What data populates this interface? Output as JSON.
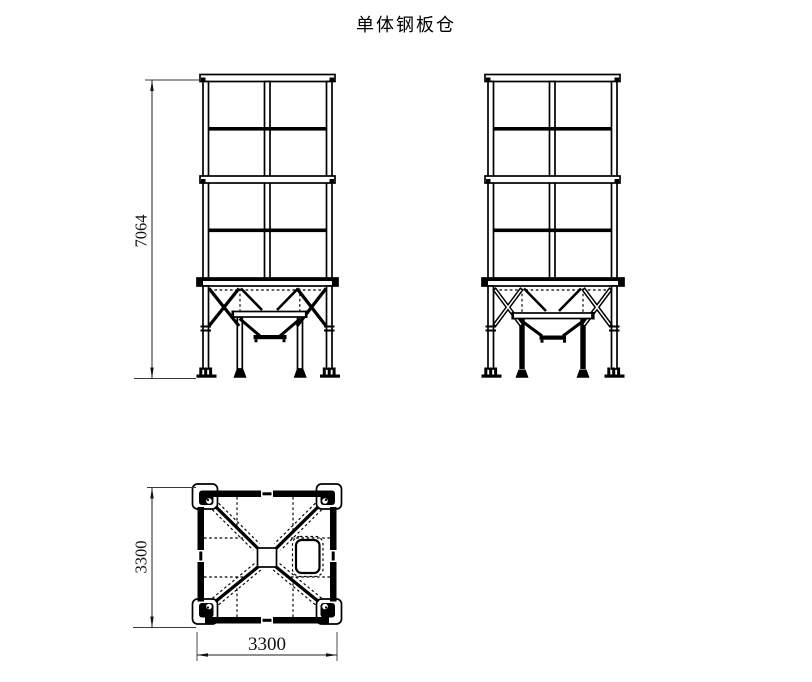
{
  "page": {
    "background": "#ffffff",
    "line_color": "#000000"
  },
  "title": {
    "text": "单体钢板仓"
  },
  "views": {
    "front_elevation": {
      "dimensions": {
        "height": "7064"
      }
    },
    "side_elevation": {},
    "plan": {
      "dimensions": {
        "width": "3300",
        "depth": "3300"
      }
    }
  }
}
